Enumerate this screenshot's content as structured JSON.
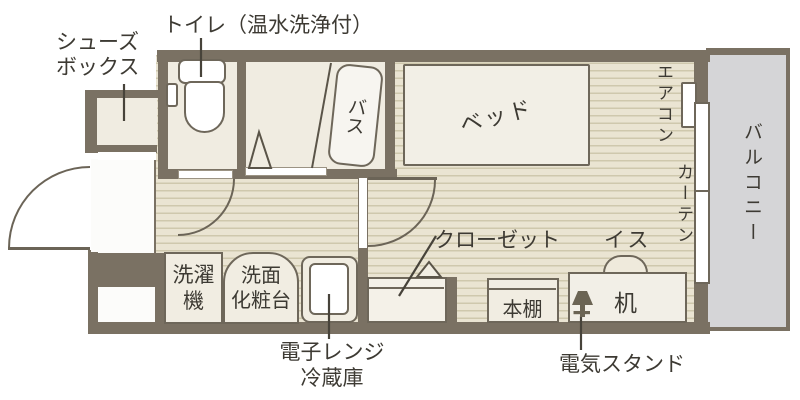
{
  "colors": {
    "wall": "#7a7163",
    "floor": "#eae4d2",
    "floor_stripe": "#cfc8ad",
    "room": "#f0ece1",
    "fixture": "#f1ede2",
    "entrance": "#fcfcfa",
    "balcony": "#d5d5d7",
    "outline": "#6e675a",
    "text": "#3d3a33",
    "lamp": "#6b6454"
  },
  "labels": {
    "shoebox_line1": "シューズ",
    "shoebox_line2": "ボックス",
    "toilet": "トイレ（温水洗浄付）",
    "bath": "バス",
    "bed": "ベッド",
    "aircon": "エアコン",
    "curtain": "カーテン",
    "balcony": "バルコニー",
    "closet": "クローゼット",
    "chair": "イス",
    "desk": "机",
    "bookshelf": "本棚",
    "washer_line1": "洗濯",
    "washer_line2": "機",
    "vanity_line1": "洗面",
    "vanity_line2": "化粧台",
    "appliance_line1": "電子レンジ",
    "appliance_line2": "冷蔵庫",
    "lamp": "電気スタンド"
  }
}
